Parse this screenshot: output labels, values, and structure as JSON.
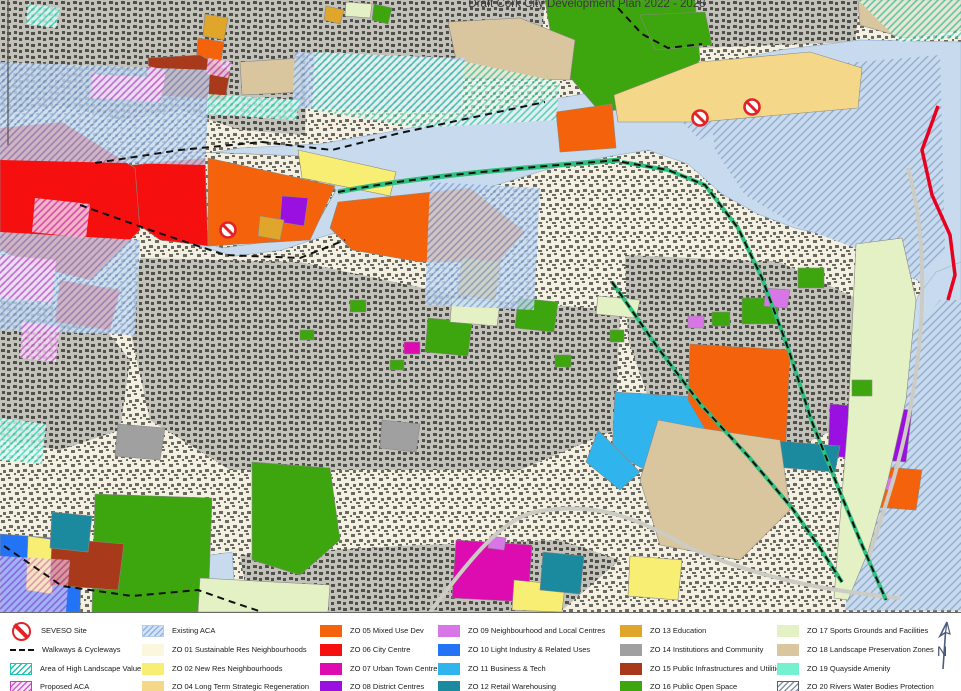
{
  "title": "Draft Cork City Development Plan 2022 - 2028",
  "north_arrow": {
    "label": "N"
  },
  "map_colors": {
    "water": "#C8DBEE",
    "water_hatch_line": "#94ACCE",
    "boundary_red": "#E8001F",
    "walkway_dash": "#111111",
    "greenway": "#2FBF7F"
  },
  "legend": {
    "c1": [
      {
        "label": "SEVESO Site",
        "type": "seveso",
        "color": "#E32228"
      },
      {
        "label": "Walkways & Cycleways",
        "type": "dash",
        "color": "#111111"
      },
      {
        "label": "Area of High Landscape Value",
        "type": "hatch",
        "line": "#1FC2AE",
        "bg": "#FFFFFF",
        "border": "#1FC2AE"
      },
      {
        "label": "Proposed ACA",
        "type": "hatch",
        "line": "#D05FD0",
        "bg": "#F6E3F6",
        "border": "#C23FC2"
      }
    ],
    "c2": [
      {
        "label": "Existing ACA",
        "type": "hatch",
        "line": "#8FB2E2",
        "bg": "#D3E3F6",
        "border": "#B7CCEA"
      },
      {
        "label": "ZO 01 Sustainable Res Neighbourhoods",
        "type": "solid",
        "color": "#FBF7DF"
      },
      {
        "label": "ZO 02 New Res Neighbourhoods",
        "type": "solid",
        "color": "#F7EE73"
      },
      {
        "label": "ZO 04 Long Term Strategic Regeneration",
        "type": "solid",
        "color": "#F4D789"
      }
    ],
    "c3": [
      {
        "label": "ZO 05 Mixed Use Dev",
        "type": "solid",
        "color": "#F4620C"
      },
      {
        "label": "ZO 06 City Centre",
        "type": "solid",
        "color": "#F50F0F"
      },
      {
        "label": "ZO 07 Urban Town Centre",
        "type": "solid",
        "color": "#DD0CB0"
      },
      {
        "label": "ZO 08 District Centres",
        "type": "solid",
        "color": "#9A10E0"
      }
    ],
    "c4": [
      {
        "label": "ZO 09 Neighbourhood and Local Centres",
        "type": "solid",
        "color": "#D876E8"
      },
      {
        "label": "ZO 10 Light Industry & Related Uses",
        "type": "solid",
        "color": "#2273F5"
      },
      {
        "label": "ZO 11 Business & Tech",
        "type": "solid",
        "color": "#2FB4EE"
      },
      {
        "label": "ZO 12 Retail Warehousing",
        "type": "solid",
        "color": "#1B8A9E"
      }
    ],
    "c5": [
      {
        "label": "ZO 13 Education",
        "type": "solid",
        "color": "#E0A62B"
      },
      {
        "label": "ZO 14 Institutions and Community",
        "type": "solid",
        "color": "#A0A0A0"
      },
      {
        "label": "ZO 15 Public Infrastructures and Utilities",
        "type": "solid",
        "color": "#A8391A"
      },
      {
        "label": "ZO 16 Public Open Space",
        "type": "solid",
        "color": "#3DA50D"
      }
    ],
    "c6": [
      {
        "label": "ZO 17 Sports Grounds and Facilities",
        "type": "solid",
        "color": "#E4F1C4"
      },
      {
        "label": "ZO 18 Landscape Preservation Zones",
        "type": "solid",
        "color": "#D9C69F"
      },
      {
        "label": "ZO 19 Quayside Amenity",
        "type": "solid",
        "color": "#74F2D0"
      },
      {
        "label": "ZO 20  Rivers Water Bodies Protection",
        "type": "hatch",
        "line": "#8593A8",
        "bg": "#FFFFFF",
        "border": "#5A5F6A"
      }
    ]
  }
}
